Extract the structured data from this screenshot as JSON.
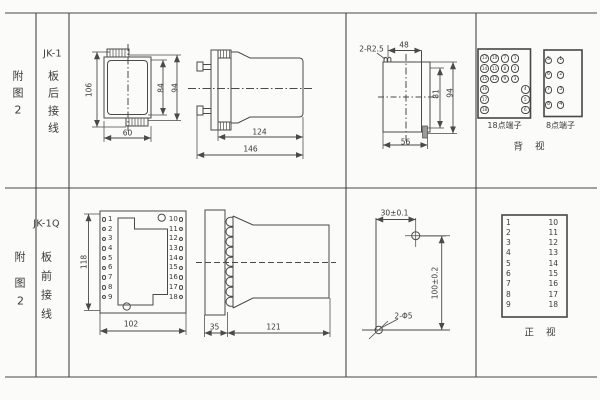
{
  "colors": {
    "line": "#4a4a4a",
    "text": "#3a3a3a",
    "background": "#fbfbf9"
  },
  "row1": {
    "figure": [
      "附",
      "图",
      "2"
    ],
    "model": "JK-1",
    "wiring": [
      "板",
      "后",
      "接",
      "线"
    ],
    "front_view_dims": {
      "height": "106",
      "inner_height": "84",
      "outer_height": "94",
      "width": "60"
    },
    "side_view_dims": {
      "body_length": "124",
      "total_length": "146"
    },
    "rear_outline_dims": {
      "corner_radius": "2-R2.5",
      "top_width": "48",
      "inner_height": "81",
      "outer_height": "94",
      "bottom_width": "56"
    },
    "t18": {
      "label": "18点端子",
      "points": [
        {
          "n": "13",
          "col": 0,
          "row": 0
        },
        {
          "n": "10",
          "col": 1,
          "row": 0
        },
        {
          "n": "7",
          "col": 2,
          "row": 0
        },
        {
          "n": "1",
          "col": 3,
          "row": 0
        },
        {
          "n": "14",
          "col": 0,
          "row": 1
        },
        {
          "n": "11",
          "col": 1,
          "row": 1
        },
        {
          "n": "8",
          "col": 2,
          "row": 1
        },
        {
          "n": "2",
          "col": 3,
          "row": 1
        },
        {
          "n": "15",
          "col": 0,
          "row": 2
        },
        {
          "n": "12",
          "col": 1,
          "row": 2
        },
        {
          "n": "9",
          "col": 2,
          "row": 2
        },
        {
          "n": "3",
          "col": 3,
          "row": 2
        },
        {
          "n": "16",
          "col": 0,
          "row": 3
        },
        {
          "n": "4",
          "col": 4,
          "row": 3
        },
        {
          "n": "17",
          "col": 0,
          "row": 4
        },
        {
          "n": "5",
          "col": 4,
          "row": 4
        },
        {
          "n": "18",
          "col": 0,
          "row": 5
        },
        {
          "n": "6",
          "col": 4,
          "row": 5
        }
      ]
    },
    "t8": {
      "label": "8点端子",
      "left": [
        "5",
        "6",
        "7",
        "8"
      ],
      "right": [
        "1",
        "2",
        "3",
        "4"
      ]
    },
    "view_label": "背 视"
  },
  "row2": {
    "figure": [
      "附",
      "图",
      "2"
    ],
    "model": "JK-1Q",
    "wiring": [
      "板",
      "前",
      "接",
      "线"
    ],
    "plate": {
      "height": "118",
      "width": "102",
      "left": [
        "1",
        "2",
        "3",
        "4",
        "5",
        "6",
        "7",
        "8",
        "9"
      ],
      "right": [
        "10",
        "11",
        "12",
        "13",
        "14",
        "15",
        "16",
        "17",
        "18"
      ]
    },
    "side_view_dims": {
      "plate_depth": "35",
      "body_length": "121"
    },
    "drill": {
      "horizontal": "30±0.1",
      "vertical": "100±0.2",
      "holes": "2-Φ5"
    },
    "table": {
      "left": [
        "1",
        "2",
        "3",
        "4",
        "5",
        "6",
        "7",
        "8",
        "9"
      ],
      "right": [
        "10",
        "11",
        "12",
        "13",
        "14",
        "15",
        "16",
        "17",
        "18"
      ],
      "view_label": "正 视"
    }
  }
}
